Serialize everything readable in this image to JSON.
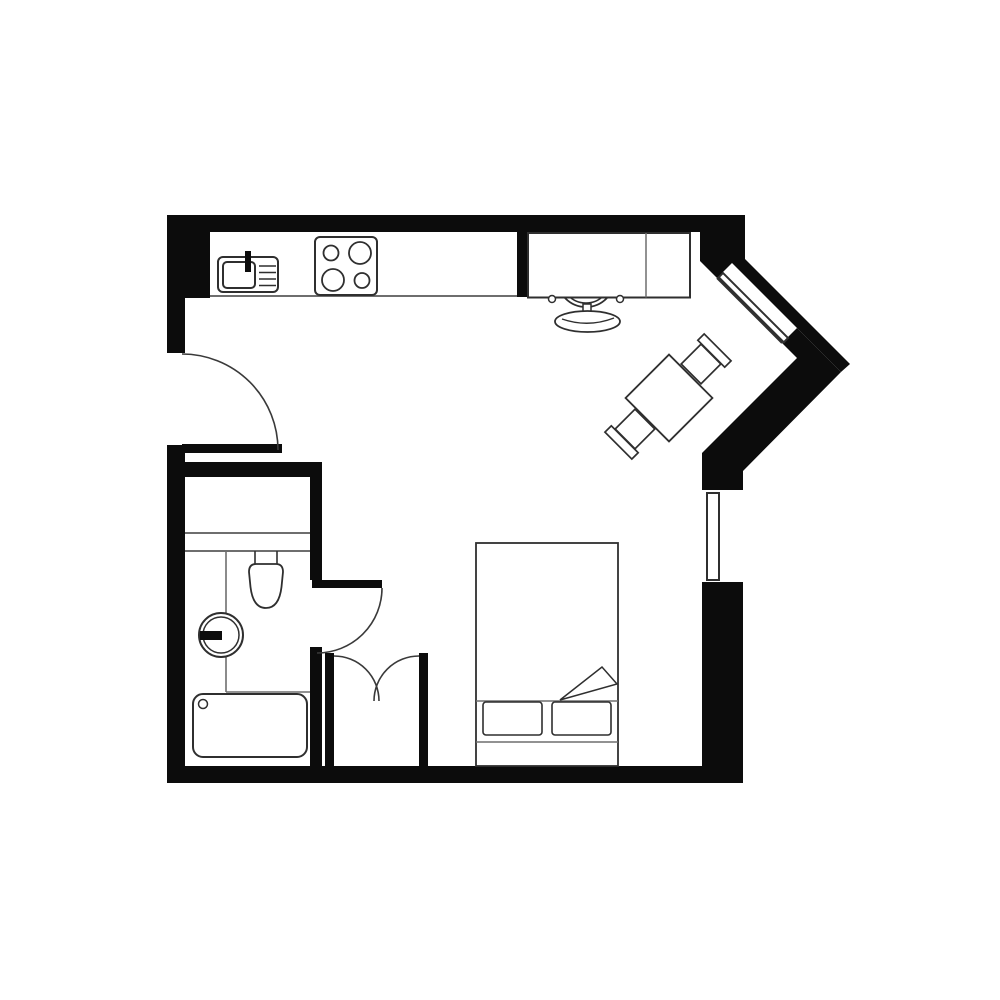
{
  "title": "Studio apartment floor plan",
  "colors": {
    "background": "#ffffff",
    "wall": "#0c0c0c",
    "furniture_line": "#2f2f2f",
    "faint_line": "#6e6e6e",
    "door_line": "#3a3a3a"
  },
  "plan": {
    "rooms": [
      {
        "name": "main-room",
        "description": "combined kitchen / living / sleeping area"
      },
      {
        "name": "bathroom",
        "description": "bottom-left room with toilet, basin and bathtub"
      },
      {
        "name": "closet",
        "description": "small nook with double doors between bathroom and bed"
      }
    ],
    "doors": [
      {
        "name": "entry-door",
        "type": "single swing",
        "location": "left wall"
      },
      {
        "name": "bathroom-door",
        "type": "single swing",
        "location": "bathroom right wall"
      },
      {
        "name": "closet-doors",
        "type": "double swing",
        "location": "closet opening"
      }
    ],
    "windows": [
      {
        "name": "diagonal-window",
        "location": "45-degree chamfered top-right wall"
      },
      {
        "name": "side-window",
        "location": "right wall"
      }
    ],
    "fixtures": [
      {
        "name": "kitchen-counter",
        "room": "main-room"
      },
      {
        "name": "kitchen-sink",
        "room": "main-room",
        "details": "basin, faucet, drainboard lines"
      },
      {
        "name": "stove",
        "room": "main-room",
        "details": "4 burners: small TL, large TR, large BL, small BR"
      },
      {
        "name": "desk",
        "room": "main-room",
        "details": "two sections divided by a line"
      },
      {
        "name": "desk-chair",
        "room": "main-room",
        "details": "round seat, two armrests, curved backrest"
      },
      {
        "name": "dining-table",
        "room": "main-room",
        "details": "square table rotated 45 degrees"
      },
      {
        "name": "dining-chair-ne",
        "room": "main-room"
      },
      {
        "name": "dining-chair-sw",
        "room": "main-room"
      },
      {
        "name": "bed",
        "room": "main-room",
        "details": "double bed, 2 pillows, folded blanket corner, headboard"
      },
      {
        "name": "ledge",
        "room": "bathroom"
      },
      {
        "name": "toilet",
        "room": "bathroom"
      },
      {
        "name": "round-basin",
        "room": "bathroom",
        "details": "double ring with black faucet bar"
      },
      {
        "name": "vanity-partition",
        "room": "bathroom"
      },
      {
        "name": "bathtub",
        "room": "bathroom",
        "details": "rounded rectangle with drain circle"
      }
    ]
  }
}
